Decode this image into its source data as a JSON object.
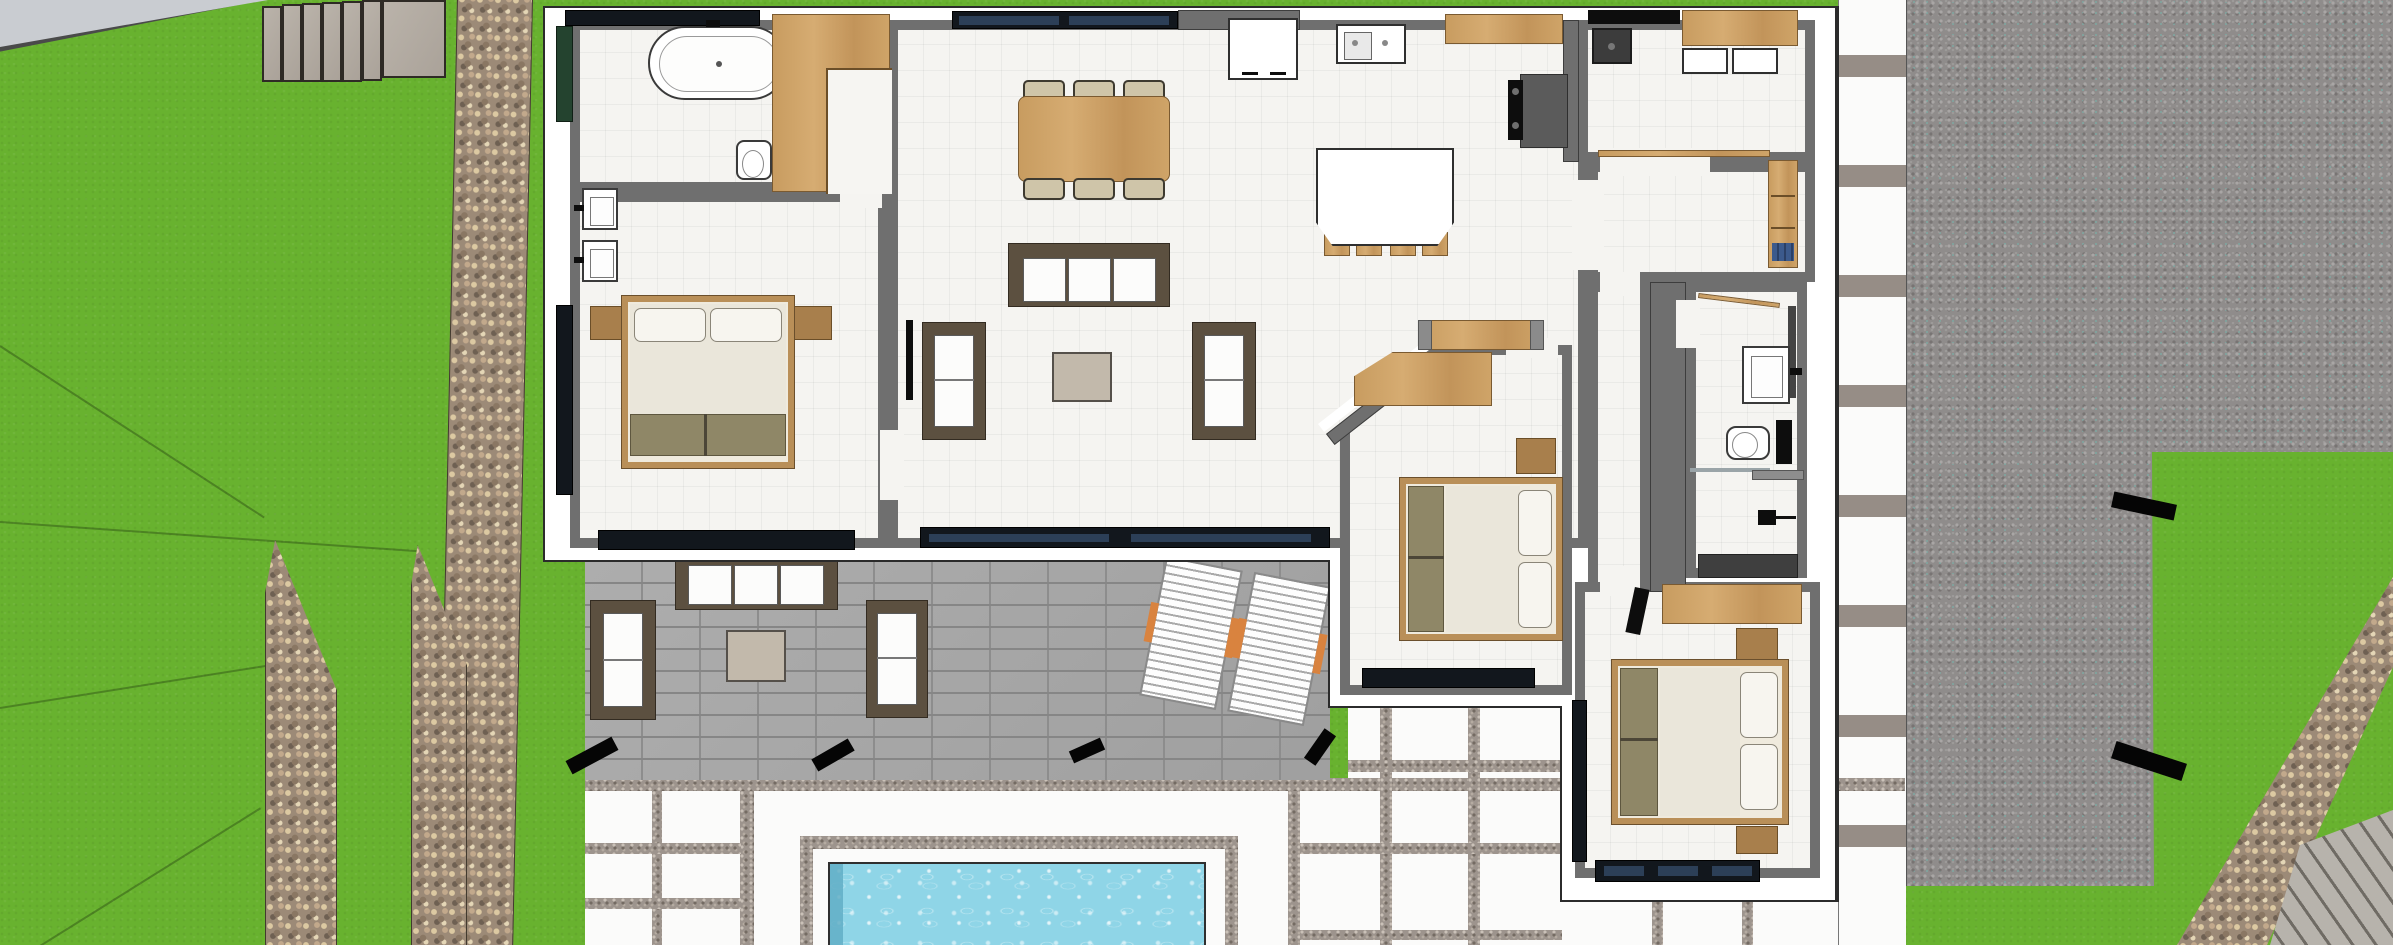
{
  "scene": {
    "kind": "sketchup-style top-down 3d architectural rendering",
    "subject": "single-storey villa floor plan with garden, patio and pool",
    "visible_text": "none"
  },
  "palette": {
    "grass": "#68b22f",
    "pebble_path": "#9c8a77",
    "gravel_field": "#8f8c8b",
    "patio_paver": "#a8a8a8",
    "deck_slab": "#fbfbfa",
    "house_wall_core": "#6f6f6f",
    "house_stucco": "#ffffff",
    "room_floor": "#f5f4f1",
    "wood": "#c89c60",
    "sofa_frame": "#5c5040",
    "upholstery": "#fcfcfb",
    "olive_fabric": "#8f8767",
    "window_glass": "#12171d",
    "pool_water": "#8fd5e7",
    "concrete_road": "#c9ccd1"
  },
  "site": {
    "areas": [
      {
        "name": "lawn",
        "coverage": "left and bottom-right"
      },
      {
        "name": "concrete-road-corner",
        "position": "top-left"
      },
      {
        "name": "garden-steps",
        "count_treads": 6,
        "landing": 1
      },
      {
        "name": "pebble-path-vertical",
        "count": 3
      },
      {
        "name": "pebble-path-diagonal",
        "position": "bottom-right"
      },
      {
        "name": "striped-plank-walk",
        "position": "bottom-right-corner"
      },
      {
        "name": "gravel-field",
        "position": "right"
      },
      {
        "name": "paver-patio",
        "position": "center-bottom"
      },
      {
        "name": "white-slab-deck",
        "position": "bottom"
      },
      {
        "name": "stepping-slab-walkway",
        "position": "right-of-house"
      },
      {
        "name": "swimming-pool",
        "position": "bottom-center"
      },
      {
        "name": "black-edge-markers",
        "count": 6
      }
    ]
  },
  "house": {
    "rooms": [
      {
        "name": "master-bathroom",
        "furniture": [
          "freestanding-oval-bathtub",
          "toilet",
          "double-sink-vanity",
          "l-shaped-wood-wardrobe",
          "top-window"
        ]
      },
      {
        "name": "master-bedroom",
        "furniture": [
          "canopy-double-bed",
          "two-nightstands",
          "foot-bench-olive",
          "full-height-window-south",
          "window-west"
        ]
      },
      {
        "name": "living-dining-room",
        "furniture": [
          "dining-table-wood",
          "six-dining-chairs",
          "sofa-three-seat",
          "two-armchairs",
          "coffee-table",
          "wall-tv",
          "sliding-glass-door-south",
          "window-north"
        ]
      },
      {
        "name": "kitchen",
        "furniture": [
          "island-with-four-stools",
          "upper-cabinet-white",
          "counter-with-double-sink",
          "wood-cabinet",
          "oven-cooktop"
        ]
      },
      {
        "name": "pantry-laundry",
        "furniture": [
          "black-counter",
          "utility-sink",
          "wood-cabinet",
          "two-appliances",
          "sliding-door-track"
        ]
      },
      {
        "name": "entry-hall",
        "furniture": [
          "tall-wood-bookcase",
          "entry-console-wood"
        ]
      },
      {
        "name": "corridor",
        "furniture": []
      },
      {
        "name": "bathroom-2",
        "furniture": [
          "vanity-sink",
          "toilet",
          "shower-dark-floor",
          "towel-bar",
          "shower-head"
        ]
      },
      {
        "name": "bedroom-2",
        "furniture": [
          "canopy-bed-horizontal",
          "wood-desk",
          "nightstand",
          "south-window"
        ],
        "feature": "chamfered-northwest-corner"
      },
      {
        "name": "bedroom-3",
        "furniture": [
          "canopy-bed-horizontal",
          "wood-desk",
          "monitor",
          "two-nightstands",
          "south-window",
          "west-window"
        ]
      }
    ]
  },
  "outdoor_furniture": [
    {
      "name": "patio-sofa",
      "cushions": 3
    },
    {
      "name": "patio-armchair",
      "count": 2
    },
    {
      "name": "patio-coffee-table"
    },
    {
      "name": "sun-lounger",
      "count": 2,
      "accent": "orange-towel"
    }
  ],
  "pool": {
    "water_color": "#8fd5e7",
    "surround": "gravel-joint-frame",
    "deck": "white-slabs",
    "cut_off_at_bottom_edge": true
  }
}
